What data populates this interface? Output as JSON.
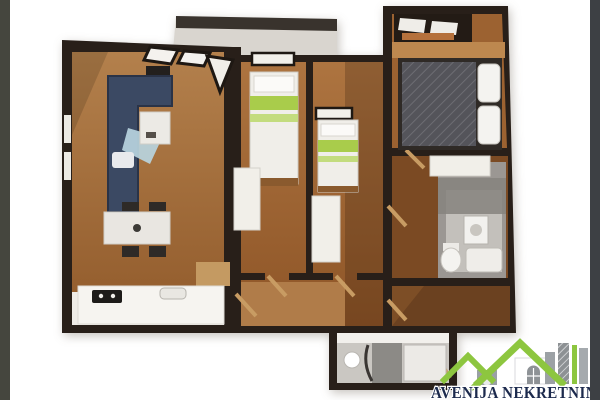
{
  "canvas": {
    "width": 600,
    "height": 400,
    "background": "#ffffff"
  },
  "side_bars": {
    "left_color": "#45463e",
    "right_color": "#3d4044"
  },
  "floor_plan": {
    "type": "3d-apartment-floor-plan-render",
    "view": "top-down dollhouse",
    "wall_color": "#281f19",
    "floor_color": "#a26a37",
    "kitchen_floor_color": "#efece7",
    "balcony_color": "#d9d5cf",
    "bed_stripe_color": "#a9cc4b",
    "sofa_color": "#3b4963",
    "duvet_color": "#54545a",
    "bathroom_tile_color": "#cac7c2",
    "rooms": [
      "living-room-with-kitchen",
      "bedroom-1",
      "bedroom-2",
      "master-bedroom",
      "bathroom",
      "shower-room",
      "hallway",
      "balcony"
    ]
  },
  "watermark": {
    "text": "AVENIJA NEKRETNIN",
    "text_color": "#1c2a4d",
    "roof_color": "#8dc63f",
    "house_color": "#ffffff",
    "building_color": "#9aa0a5"
  }
}
